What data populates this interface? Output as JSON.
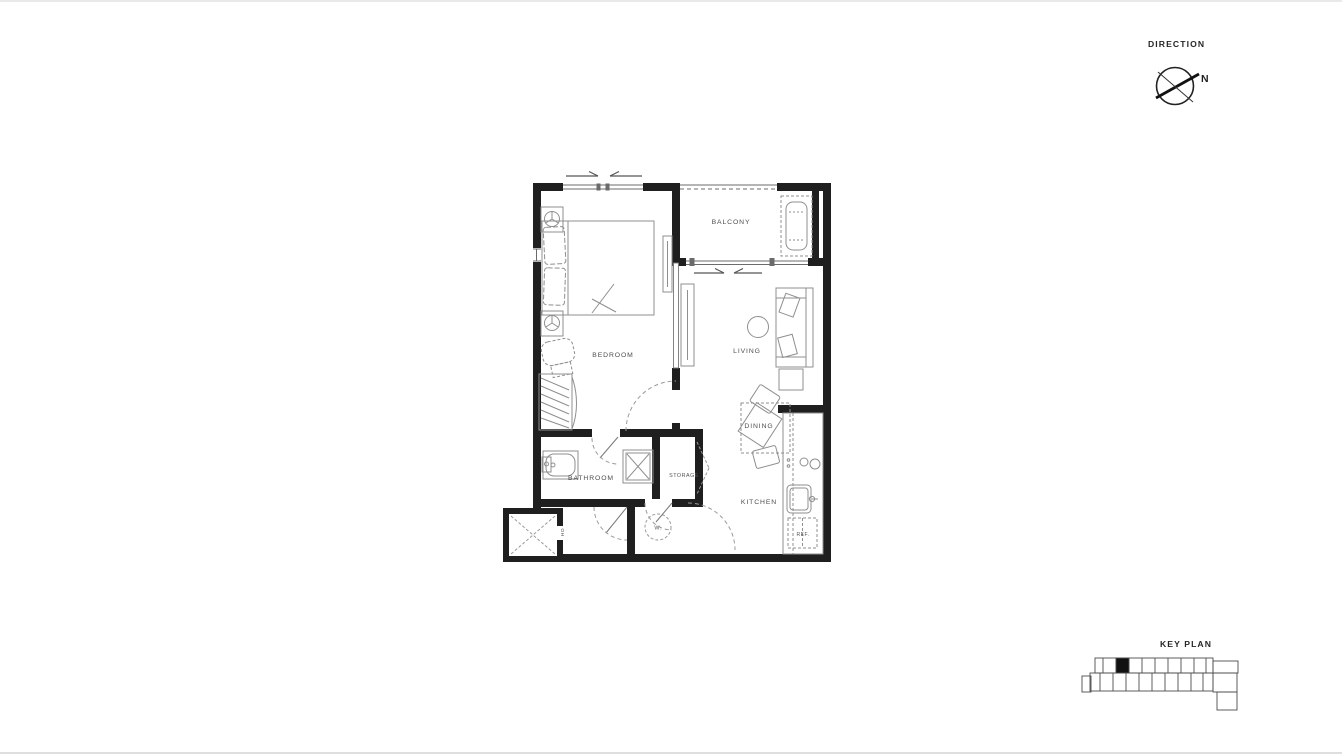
{
  "direction_panel": {
    "title": "DIRECTION",
    "north_label": "N"
  },
  "key_plan_panel": {
    "title": "KEY PLAN"
  },
  "floor_plan": {
    "labels": {
      "balcony": "BALCONY",
      "bedroom": "BEDROOM",
      "living": "LIVING",
      "dining": "DINING",
      "kitchen": "KITCHEN",
      "bathroom": "BATHROOM",
      "storage": "STORAGE",
      "washer": "W.",
      "refrigerator": "REF.",
      "utility": "HO"
    }
  },
  "colors": {
    "background": "#ffffff",
    "wall": "#1f1f1f",
    "structure_line": "#6b6b6b",
    "furniture_line": "#8f8f8f",
    "dash_line": "#9a9a9a",
    "label_text": "#4d4d4d",
    "panel_text": "#262626"
  }
}
